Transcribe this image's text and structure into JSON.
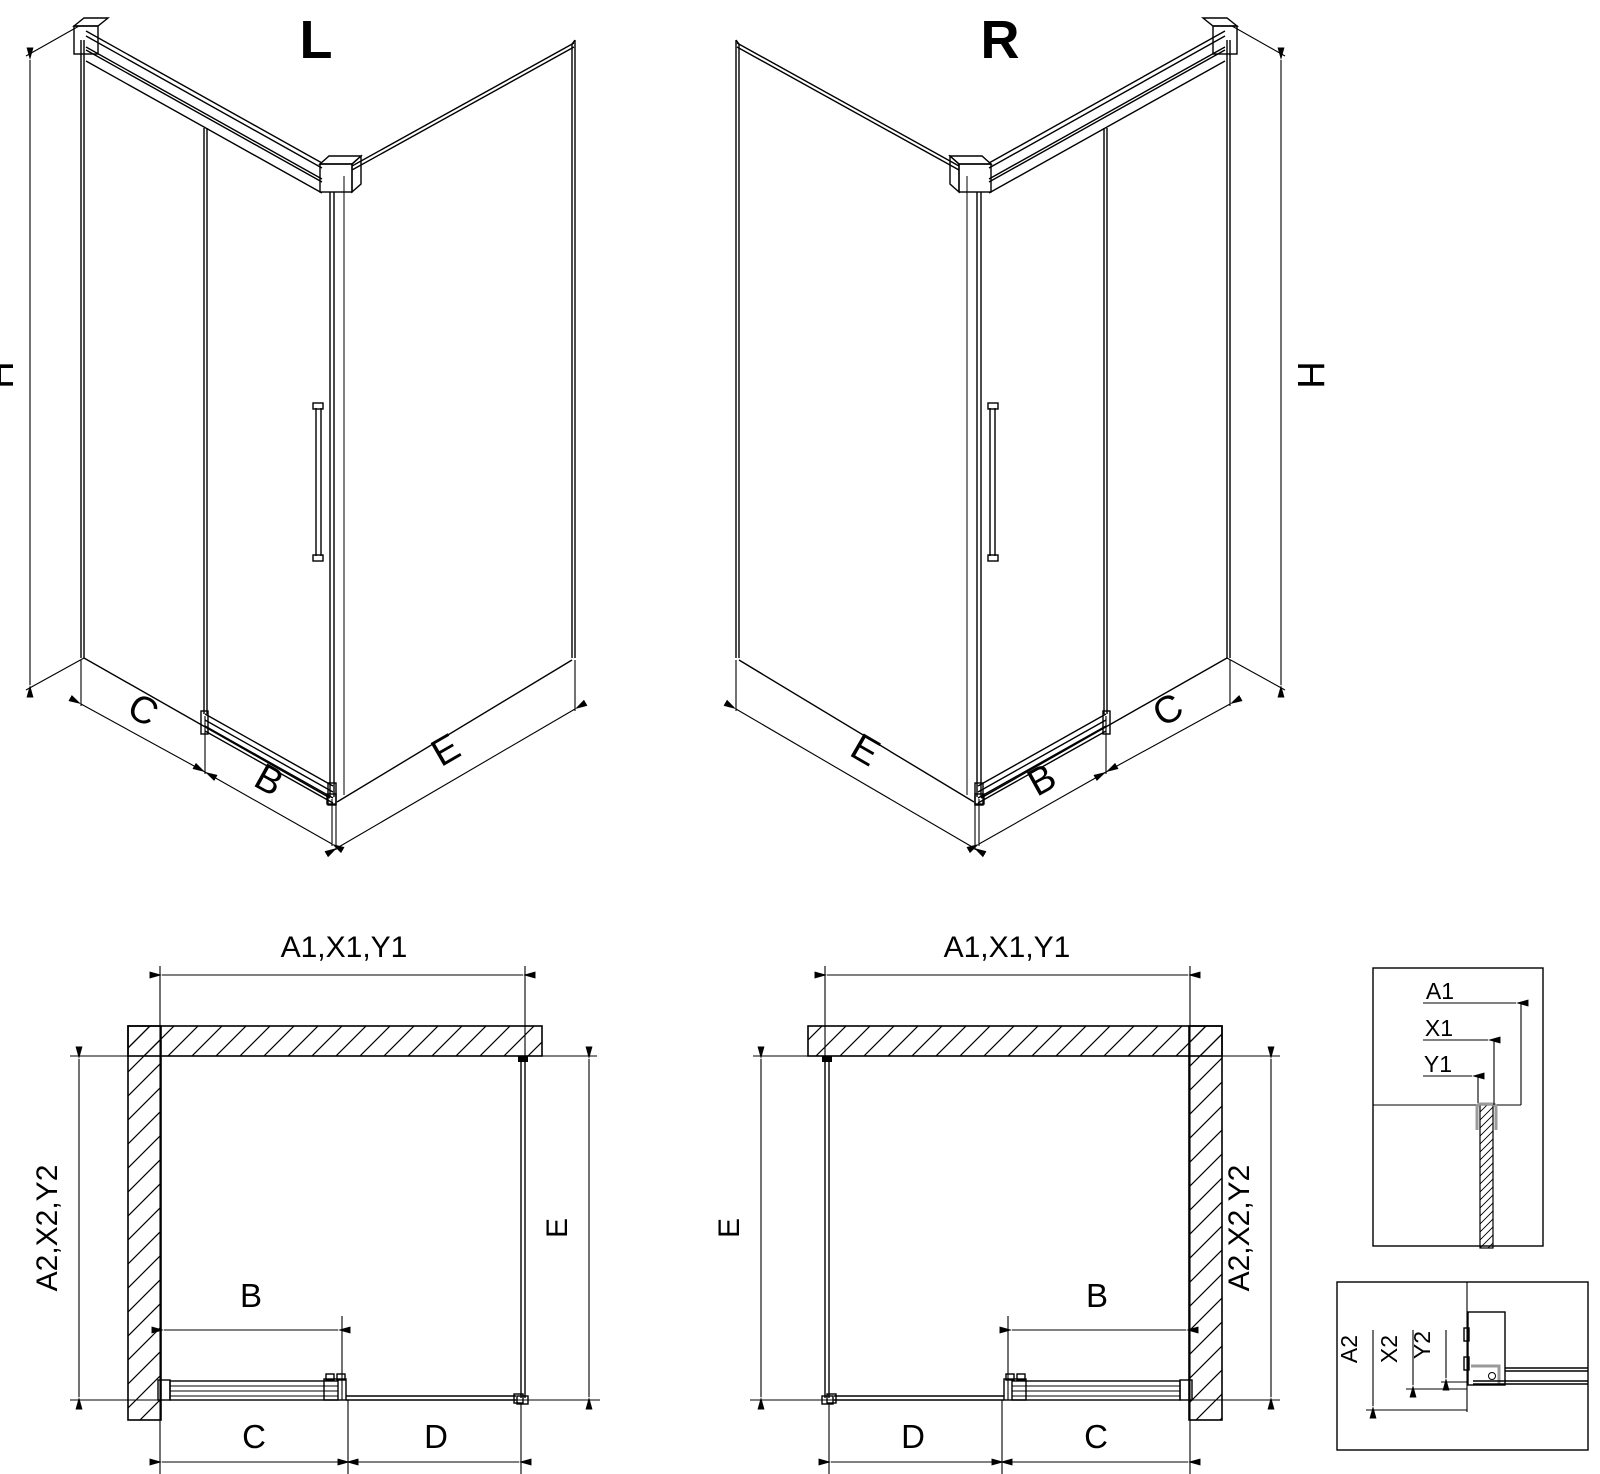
{
  "colors": {
    "line": "#000000",
    "detail_gray": "#808080",
    "hardware_gray": "#9a9a9a",
    "background": "#ffffff"
  },
  "views": {
    "iso_left": {
      "title": "L",
      "dim_height": "H",
      "dim_fixed_panel": "C",
      "dim_door": "B",
      "dim_side_panel": "E"
    },
    "iso_right": {
      "title": "R",
      "dim_height": "H",
      "dim_fixed_panel": "C",
      "dim_door": "B",
      "dim_side_panel": "E"
    },
    "plan_left": {
      "dim_width": "A1,X1,Y1",
      "dim_depth": "A2,X2,Y2",
      "dim_door": "B",
      "dim_bottom_first": "C",
      "dim_bottom_second": "D",
      "dim_side": "E"
    },
    "plan_right": {
      "dim_width": "A1,X1,Y1",
      "dim_depth": "A2,X2,Y2",
      "dim_door": "B",
      "dim_bottom_first": "D",
      "dim_bottom_second": "C",
      "dim_side": "E"
    },
    "detail_top": {
      "labels": [
        "A1",
        "X1",
        "Y1"
      ]
    },
    "detail_bottom": {
      "labels": [
        "A2",
        "X2",
        "Y2"
      ]
    }
  }
}
